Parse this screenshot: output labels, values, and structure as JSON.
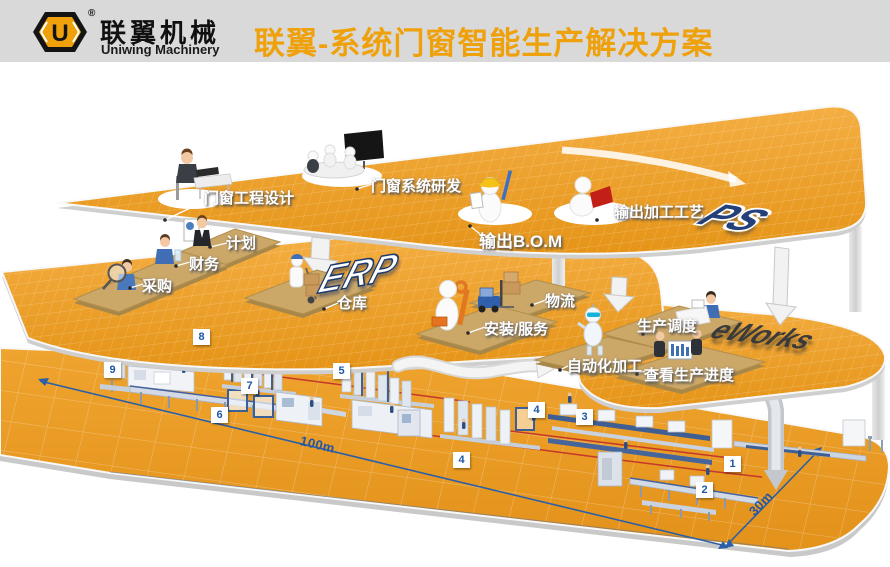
{
  "colors": {
    "accent_orange": "#EFA10C",
    "platform_orange": "#EDA02A",
    "mat_tan": "#CBA768",
    "dimension_blue": "#2B5FA8",
    "path_red": "#C4372A",
    "header_gray": "#D9D9D9"
  },
  "header": {
    "logo_letter": "U",
    "registered": "®",
    "brand_cn": "联翼机械",
    "brand_en": "Uniwing Machinery",
    "title": "联翼-系统门窗智能生产解决方案"
  },
  "layers": {
    "ps": {
      "big_label": "PS",
      "stations": {
        "design": "门窗工程设计",
        "rnd": "门窗系统研发",
        "bom": "输出B.O.M",
        "process": "输出加工工艺"
      }
    },
    "erp": {
      "big_label": "ERP",
      "stations": {
        "plan": "计划",
        "finance": "财务",
        "purchase": "采购",
        "warehouse": "仓库",
        "logistics": "物流",
        "install": "安装/服务"
      }
    },
    "eworks": {
      "big_label": "eWorks",
      "stations": {
        "dispatch": "生产调度",
        "auto": "自动化加工",
        "progress": "查看生产进度"
      }
    }
  },
  "floor": {
    "markers": [
      "8",
      "9",
      "7",
      "6",
      "5",
      "4",
      "4",
      "3",
      "1",
      "2"
    ],
    "dimensions": {
      "length": "100m",
      "width": "30m"
    }
  }
}
